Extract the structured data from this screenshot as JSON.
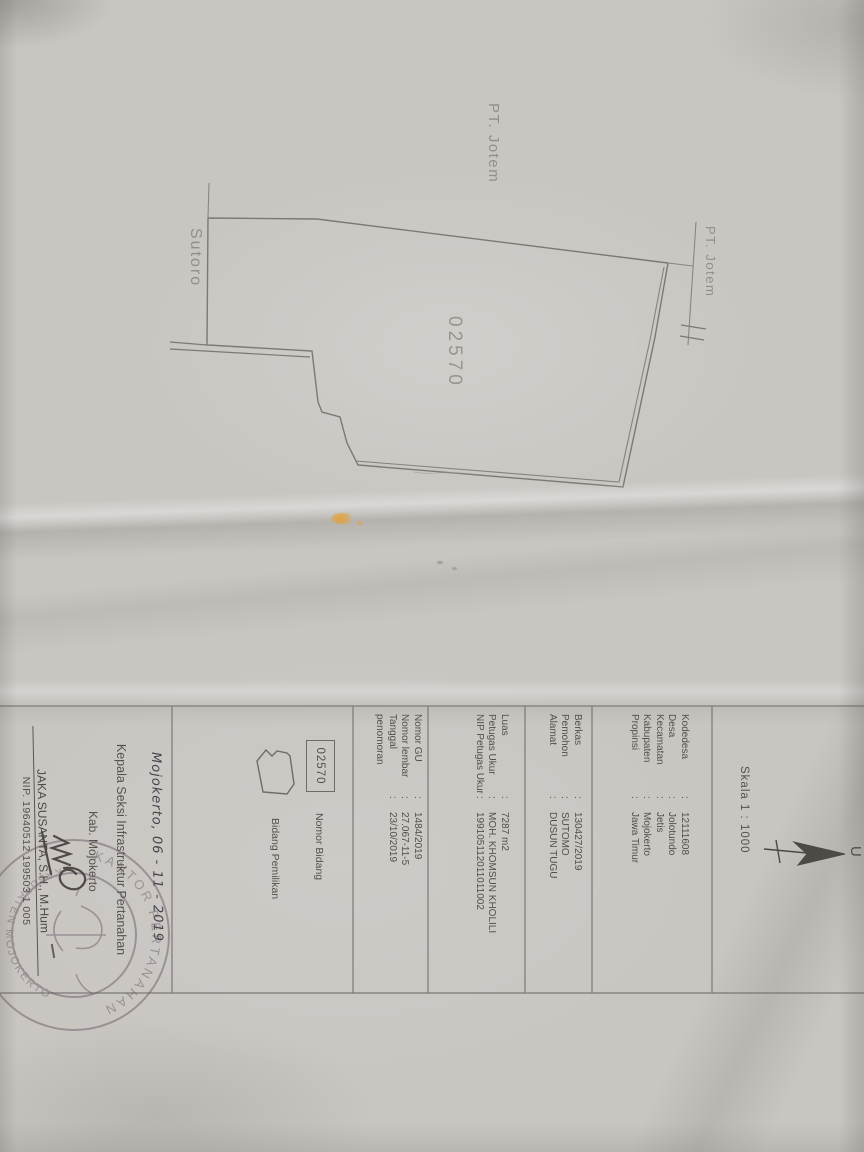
{
  "punct": {
    "colon": ":"
  },
  "compass": {
    "north_letter": "U",
    "scale_label": "Skala 1 : 1000"
  },
  "map": {
    "parcel_number": "02570",
    "neighbor_top_label": "PT. Jotem",
    "neighbor_right_label": "PT. Jotem",
    "road_label": "Sutoro"
  },
  "panel": {
    "village": {
      "rows": [
        {
          "label": "Kodedesa",
          "value": "12111608"
        },
        {
          "label": "Desa",
          "value": "Jolotundo"
        },
        {
          "label": "Kecamatan",
          "value": "Jetis"
        },
        {
          "label": "Kabupaten",
          "value": "Mojokerto"
        },
        {
          "label": "Propinsi",
          "value": "Jawa Timur"
        }
      ]
    },
    "application": {
      "rows": [
        {
          "label": "Berkas",
          "value": "130427/2019"
        },
        {
          "label": "Pemohon",
          "value": "SUTOMO"
        },
        {
          "label": "Alamat",
          "value": "DUSUN TUGU"
        }
      ]
    },
    "survey": {
      "rows": [
        {
          "label": "Luas",
          "value": "7287 m2"
        },
        {
          "label": "Petugas Ukur",
          "value": "MOH. KHOMSUN KHOLILI"
        },
        {
          "label": "NIP Petugas Ukur",
          "value": "199105112011011002"
        }
      ]
    },
    "numbering": {
      "rows": [
        {
          "label": "Nomor GU",
          "value": "1484/2019"
        },
        {
          "label": "Nomor lembar",
          "value": "27.067-11-5"
        },
        {
          "label": "Tanggal penomoran",
          "value": "23/10/2019"
        }
      ]
    },
    "legend": {
      "parcel_number": "02570",
      "nomor_bidang_label": "Nomor Bidang",
      "bidang_pemilikan_label": "Bidang Pemilikan"
    },
    "signature": {
      "place_date": "Mojokerto, 06 - 11 - 2019",
      "title_line1": "Kepala Seksi Infrastruktur Pertanahan",
      "title_line2": "Kab. Mojokerto",
      "name": "JAKA SUSANTA, S.H., M.Hum",
      "nip": "NIP. 19640512 199503 1 005",
      "stamp_text_top": "KANTOR PERTANAHAN",
      "stamp_text_bottom": "KABUPATEN MOJOKERTO"
    }
  },
  "colors": {
    "paper": "#c9c6c2",
    "ink": "#53504c",
    "map_line": "#7c7873",
    "faint_label": "#8d8983",
    "stamp": "#6d5c68",
    "handwriting": "#45434a",
    "smudge_orange": "#e0a23f"
  }
}
